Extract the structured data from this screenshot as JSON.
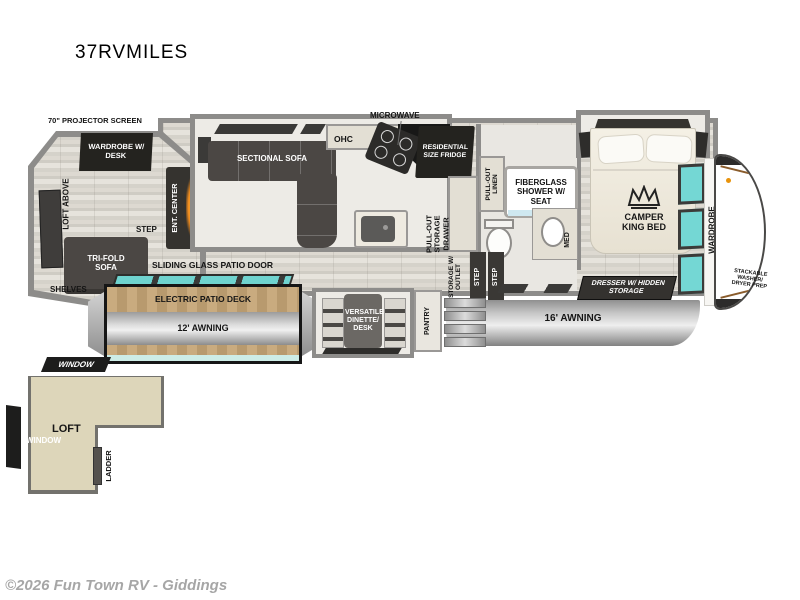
{
  "title": "37RVMILES",
  "footer": {
    "copyright": "©2026 Fun Town RV - Giddings"
  },
  "colors": {
    "wall_gray": "#8d8c8a",
    "furniture_dark": "#4b4744",
    "label_black": "#24231f",
    "window_teal": "#74d7d4",
    "loft_beige": "#ddd6ba",
    "deck_wood": "#c2a478",
    "awning_gray": "#c9c9c9",
    "flame_orange": "#f08c1e",
    "accent_brown": "#8a5c2c"
  },
  "plan": {
    "rear": {
      "projector_screen": "70\" PROJECTOR SCREEN",
      "wardrobe_desk": "WARDROBE W/ DESK",
      "loft_above": "LOFT ABOVE",
      "ent_center": "ENT. CENTER",
      "trifold_sofa": "TRI-FOLD SOFA",
      "step": "STEP",
      "shelves": "SHELVES"
    },
    "living": {
      "sectional_sofa": "SECTIONAL SOFA",
      "ohc": "OHC",
      "microwave": "MICROWAVE",
      "fridge": "RESIDENTIAL SIZE FRIDGE",
      "pullout_storage_drawer": "PULL-OUT STORAGE DRAWER",
      "sliding_glass_door": "SLIDING GLASS PATIO DOOR"
    },
    "bath": {
      "pullout_linen": "PULL-OUT LINEN",
      "shower": "FIBERGLASS SHOWER W/ SEAT",
      "med": "MED",
      "storage_outlet": "STORAGE W/ OUTLET",
      "step_upper": "STEP",
      "step_lower": "STEP"
    },
    "bedroom": {
      "bed": "CAMPER KING BED",
      "dresser": "DRESSER W/ HIDDEN STORAGE",
      "wardrobe": "WARDROBE",
      "washer_prep": "STACKABLE WASHER/ DRYER PREP"
    },
    "exterior": {
      "patio_door_label": "SLIDING GLASS PATIO DOOR",
      "patio_deck": "ELECTRIC PATIO DECK",
      "awning_12": "12' AWNING",
      "awning_16": "16' AWNING",
      "dinette": "VERSATILE DINETTE/ DESK",
      "pantry": "PANTRY"
    },
    "loft": {
      "window_top": "WINDOW",
      "window_side": "WINDOW",
      "loft": "LOFT",
      "ladder": "LADDER"
    }
  }
}
